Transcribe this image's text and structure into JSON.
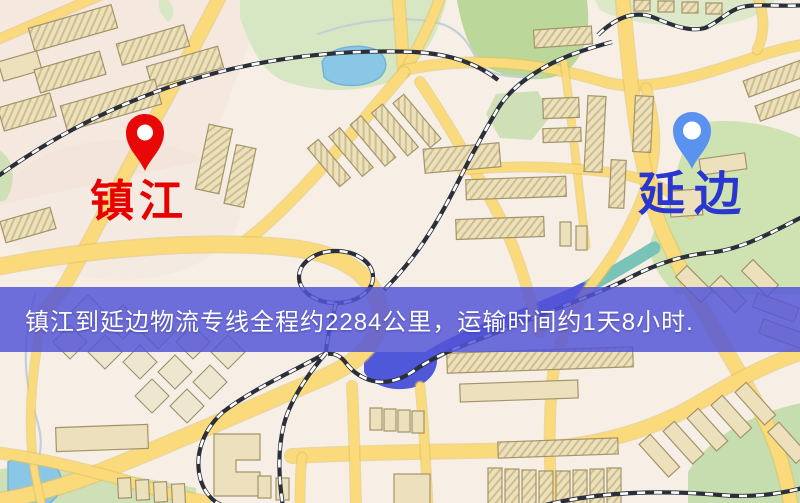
{
  "banner": {
    "text": "镇江到延边物流专线全程约2284公里，运输时间约1天8小时.",
    "background_color": "#5455d8",
    "text_color": "#ffffff"
  },
  "markers": {
    "origin": {
      "label": "镇江",
      "pin_icon": "map-pin",
      "pin_color": "#e80808",
      "label_color": "#e60000"
    },
    "destination": {
      "label": "延边",
      "pin_icon": "map-pin",
      "pin_color": "#5a92f0",
      "label_color": "#2b36cf"
    }
  },
  "route_info": {
    "origin_city": "镇江",
    "destination_city": "延边",
    "service_type": "物流专线",
    "distance": "约2284公里",
    "transit_time": "约1天8小时"
  },
  "map_palette": {
    "background": "#f7efe6",
    "road_fill": "#f9da7e",
    "road_casing": "#e2c25c",
    "building_fill": "#ece1bd",
    "building_outline": "#a2946c",
    "park_green": "#d8e7c4",
    "dark_green": "#bcd89c",
    "pond_blue": "#8cc6e4",
    "river_blue": "#4f58d4",
    "teal_river": "#7cc2b8",
    "railway_dark": "#2a2f3a"
  }
}
